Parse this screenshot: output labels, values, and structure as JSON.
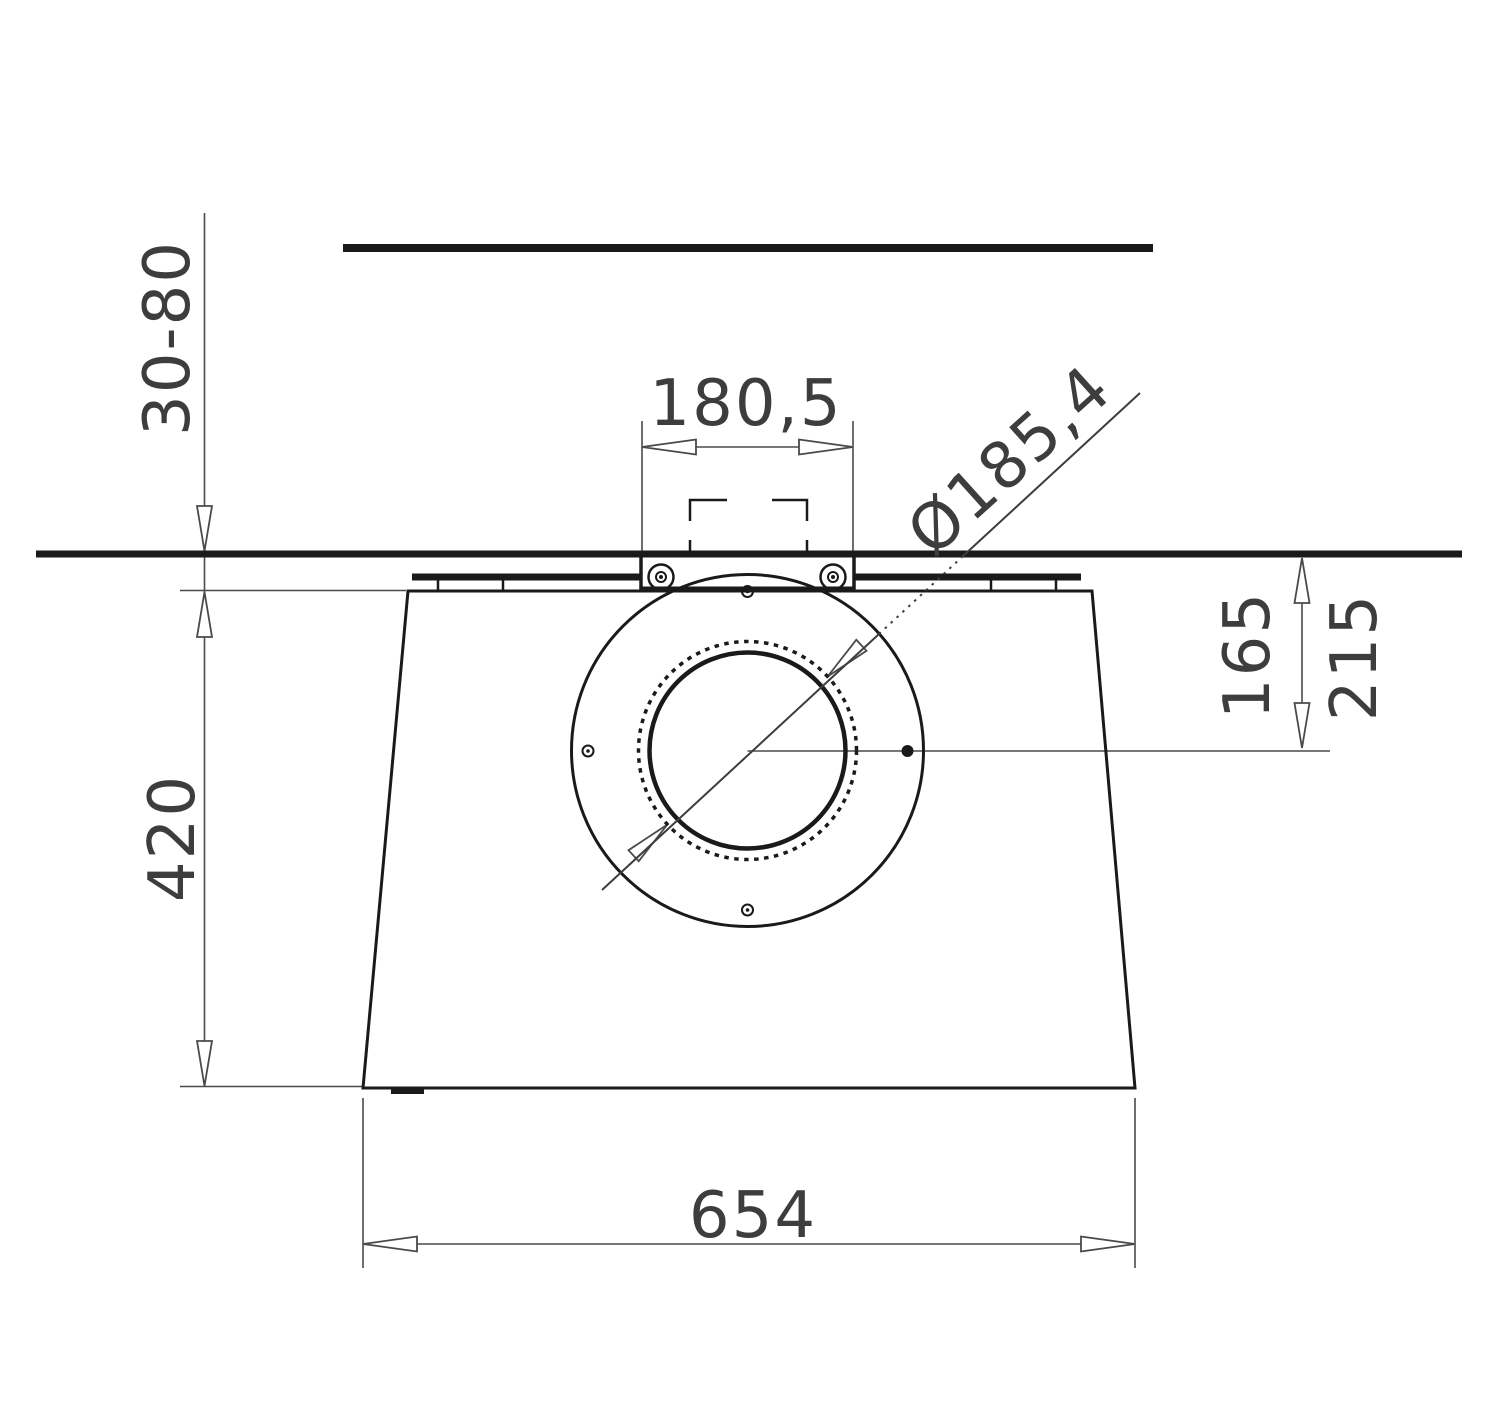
{
  "drawing": {
    "labels": {
      "ceiling_gap_range": "30-80",
      "cutout_width": "180,5",
      "hole_diameter": "Ø185,4",
      "center_offset_inner": "165",
      "center_offset_outer": "215",
      "body_height": "420",
      "body_width": "654"
    },
    "colors": {
      "background": "#ffffff",
      "outline": "#1a1a1a",
      "dimension_lines": "#4a4a4a",
      "text": "#3d3d3d"
    }
  }
}
